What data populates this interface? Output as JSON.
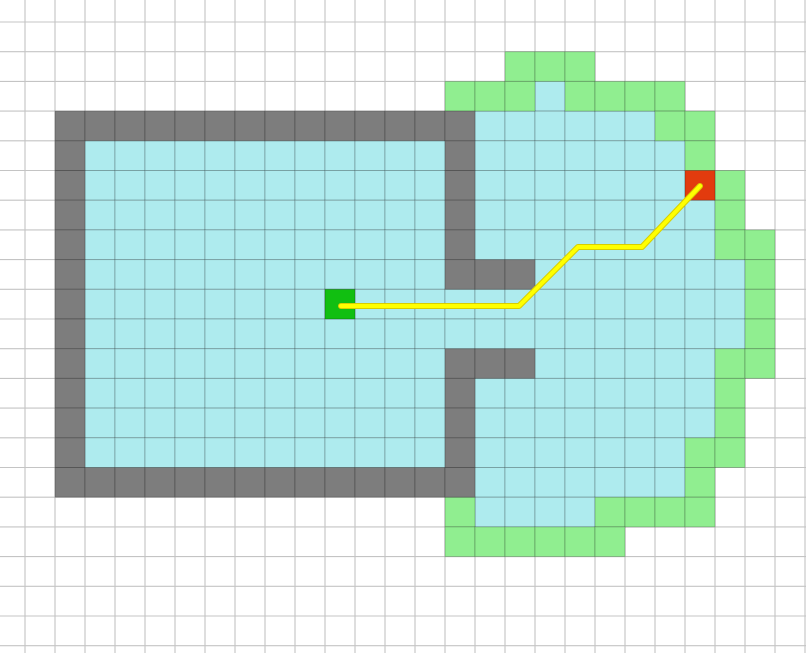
{
  "scene": {
    "width": 806,
    "height": 653
  },
  "grid": {
    "cols": 28,
    "rows": 23,
    "cell_width": 30,
    "cell_height": 29.7,
    "origin_x": -5,
    "origin_y": -7.7,
    "background_color": "#ffffff",
    "line_color": "#c4c4c4",
    "line_width": 1.1
  },
  "colors": {
    "wall": "#7d7d7d",
    "explored": "#aeebee",
    "frontier": "#90ee90",
    "cell_border": "rgba(0,0,0,0.22)"
  },
  "cells": {
    "walls": [
      {
        "r0": 4,
        "r1": 4,
        "c0": 2,
        "c1": 15
      },
      {
        "r0": 5,
        "r1": 15,
        "c0": 2,
        "c1": 2
      },
      {
        "r0": 5,
        "r1": 9,
        "c0": 15,
        "c1": 15
      },
      {
        "r0": 9,
        "r1": 9,
        "c0": 16,
        "c1": 17
      },
      {
        "r0": 12,
        "r1": 12,
        "c0": 15,
        "c1": 17
      },
      {
        "r0": 13,
        "r1": 15,
        "c0": 15,
        "c1": 15
      },
      {
        "r0": 16,
        "r1": 16,
        "c0": 2,
        "c1": 15
      }
    ],
    "explored": [
      {
        "r0": 5,
        "r1": 15,
        "c0": 3,
        "c1": 14
      },
      {
        "r0": 3,
        "r1": 3,
        "c0": 18,
        "c1": 18
      },
      {
        "r0": 4,
        "r1": 4,
        "c0": 16,
        "c1": 21
      },
      {
        "r0": 5,
        "r1": 6,
        "c0": 16,
        "c1": 22
      },
      {
        "r0": 7,
        "r1": 8,
        "c0": 16,
        "c1": 23
      },
      {
        "r0": 9,
        "r1": 9,
        "c0": 18,
        "c1": 24
      },
      {
        "r0": 10,
        "r1": 11,
        "c0": 15,
        "c1": 24
      },
      {
        "r0": 12,
        "r1": 12,
        "c0": 18,
        "c1": 23
      },
      {
        "r0": 13,
        "r1": 14,
        "c0": 16,
        "c1": 23
      },
      {
        "r0": 15,
        "r1": 16,
        "c0": 16,
        "c1": 22
      },
      {
        "r0": 17,
        "r1": 17,
        "c0": 16,
        "c1": 19
      }
    ],
    "frontier": [
      {
        "r0": 2,
        "r1": 2,
        "c0": 17,
        "c1": 19
      },
      {
        "r0": 3,
        "r1": 3,
        "c0": 15,
        "c1": 17
      },
      {
        "r0": 3,
        "r1": 3,
        "c0": 19,
        "c1": 22
      },
      {
        "r0": 4,
        "r1": 4,
        "c0": 22,
        "c1": 23
      },
      {
        "r0": 5,
        "r1": 5,
        "c0": 23,
        "c1": 23
      },
      {
        "r0": 6,
        "r1": 7,
        "c0": 24,
        "c1": 24
      },
      {
        "r0": 8,
        "r1": 8,
        "c0": 24,
        "c1": 25
      },
      {
        "r0": 9,
        "r1": 11,
        "c0": 25,
        "c1": 25
      },
      {
        "r0": 12,
        "r1": 12,
        "c0": 24,
        "c1": 25
      },
      {
        "r0": 13,
        "r1": 14,
        "c0": 24,
        "c1": 24
      },
      {
        "r0": 15,
        "r1": 15,
        "c0": 23,
        "c1": 24
      },
      {
        "r0": 16,
        "r1": 16,
        "c0": 23,
        "c1": 23
      },
      {
        "r0": 17,
        "r1": 17,
        "c0": 15,
        "c1": 15
      },
      {
        "r0": 17,
        "r1": 17,
        "c0": 20,
        "c1": 23
      },
      {
        "r0": 18,
        "r1": 18,
        "c0": 15,
        "c1": 20
      }
    ]
  },
  "start_marker": {
    "col": 11,
    "row": 10,
    "color": "#11bf11"
  },
  "goal_marker": {
    "col": 23,
    "row": 6,
    "color": "#e23b0e"
  },
  "path": {
    "points": [
      [
        341,
        306
      ],
      [
        519,
        306
      ],
      [
        578,
        247
      ],
      [
        642,
        247
      ],
      [
        700,
        186
      ]
    ],
    "core_color": "#ffff00",
    "core_width": 4,
    "edge_color": "#d8ce00",
    "edge_width": 6
  }
}
